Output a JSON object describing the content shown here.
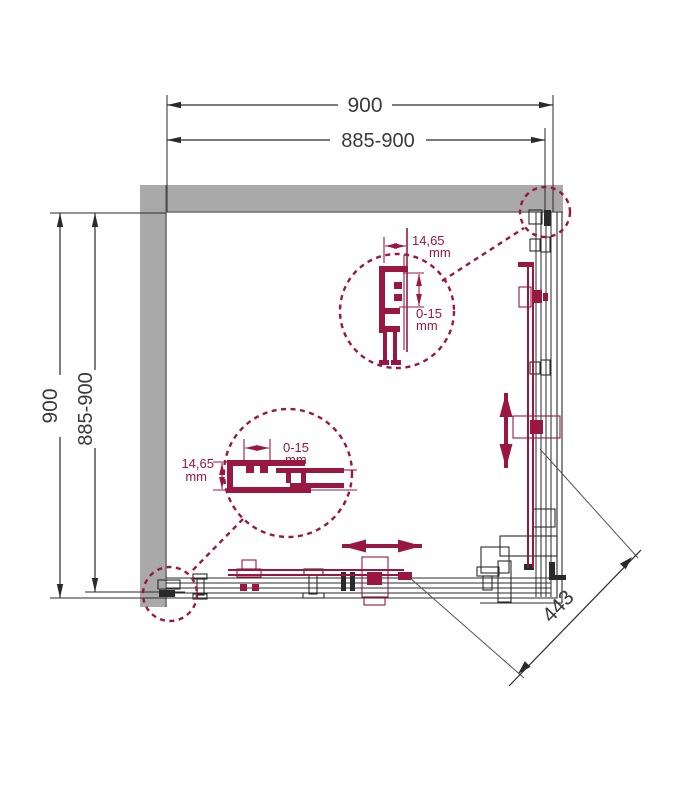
{
  "drawing": {
    "dim_top_outer": "900",
    "dim_top_inner": "885-900",
    "dim_left_outer": "900",
    "dim_left_inner": "885-900",
    "dim_diagonal": "443",
    "detail_top": {
      "width_value": "14,65",
      "width_unit": "mm",
      "range_value": "0-15",
      "range_unit": "mm"
    },
    "detail_side": {
      "range_value": "0-15",
      "range_unit": "mm",
      "width_value": "14,65",
      "width_unit": "mm"
    }
  },
  "colors": {
    "accent": "#9a1741",
    "wall_fill": "#a9a9a9",
    "wall_edge": "#6e6e6e",
    "line": "#2a2a2a",
    "leader": "#555555",
    "dim_text": "#3a3a3a",
    "background": "#ffffff"
  }
}
